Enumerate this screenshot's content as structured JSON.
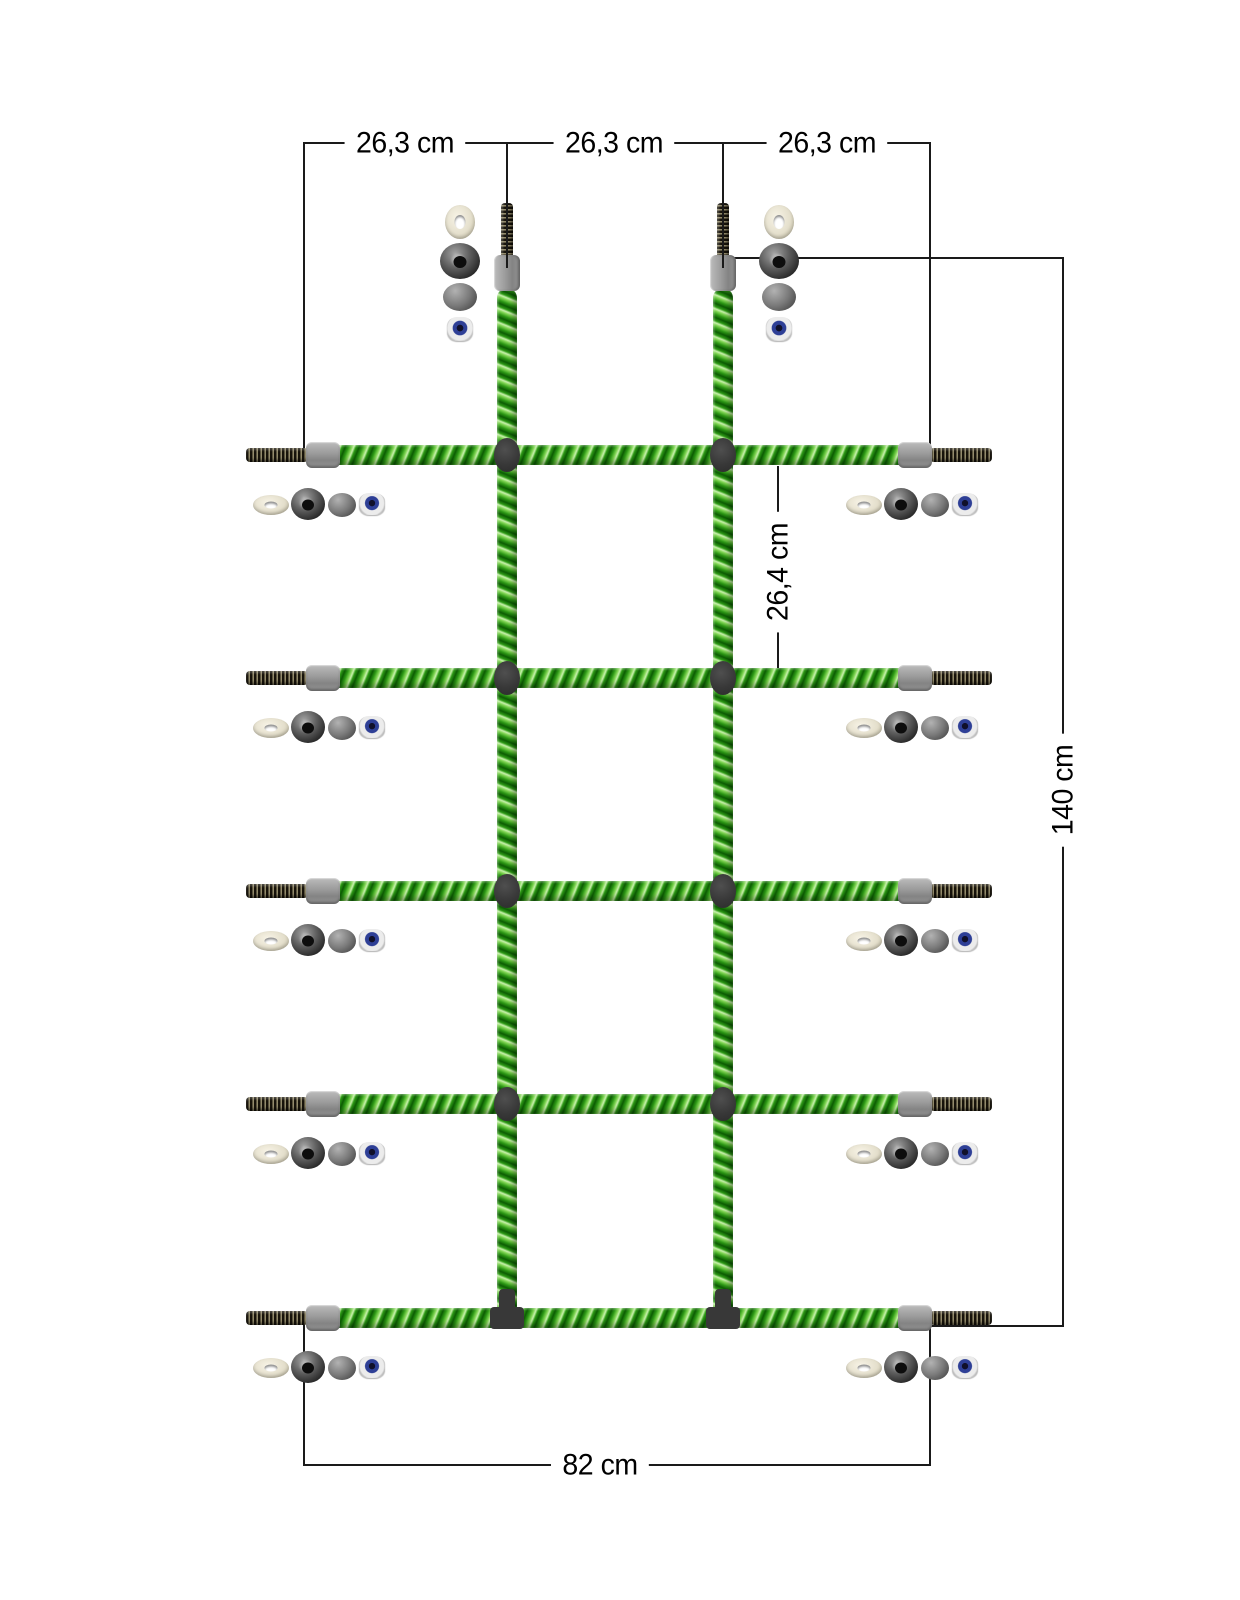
{
  "dimensions": {
    "top_left": "26,3 cm",
    "top_middle": "26,3 cm",
    "top_right": "26,3 cm",
    "row_gap": "26,4 cm",
    "total_height": "140 cm",
    "total_width": "82 cm"
  },
  "colors": {
    "rope_green": "#2e9a16",
    "rope_highlight": "#c9f2ad",
    "connector_dark": "#383838",
    "ferrule_gray": "#9a9a9a",
    "rod_brown": "#5c5540",
    "washer_ivory": "#e4dfcc",
    "locknut_blue": "#2e3f96",
    "dimension_line": "#1a1a1a",
    "background": "#ffffff"
  }
}
